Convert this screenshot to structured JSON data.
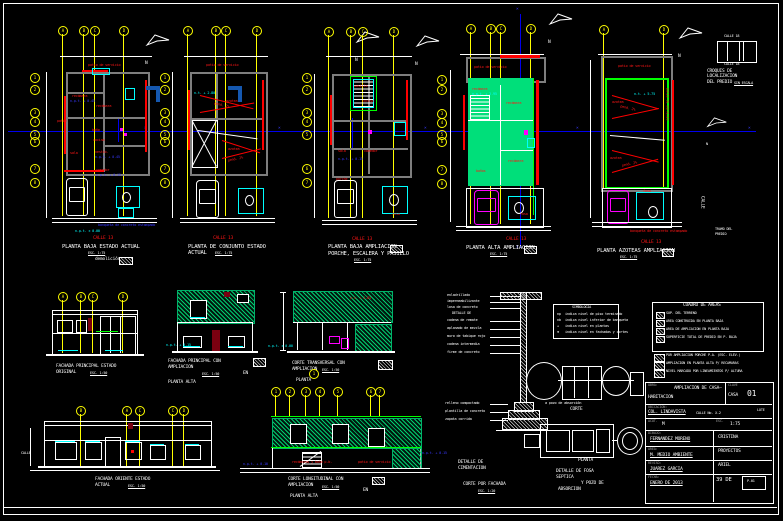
{
  "colors": {
    "background": "#000000",
    "lines": "#ffffff",
    "walls": "#7e7e7e",
    "red": "#ff0000",
    "yellow": "#ffff00",
    "cyan": "#00ffff",
    "blue": "#0000ee",
    "magenta": "#ff00ff",
    "green": "#00ff00",
    "green_fill": "#00df7a",
    "dark_red": "#7a0010",
    "dark_blue": "#1558b0"
  },
  "icons": {
    "x_marker": "×",
    "north": "N"
  },
  "grid": {
    "letters": [
      "A",
      "B",
      "C",
      "D"
    ],
    "numbers": [
      "1",
      "2",
      "3",
      "4",
      "5",
      "6",
      "7",
      "8"
    ]
  },
  "p1": {
    "t": "PLANTA BAJA ESTADO ACTUAL",
    "s": "ESC. 1:75",
    "note": "demolición",
    "street": "CALLE 13",
    "lv0": "n.p.t. ± 0.00",
    "walk": "banqueta de concreto estampado",
    "top": "patio de servicio",
    "r1": "recámara",
    "r2": "recámara",
    "r3": "baño",
    "r4": "patio",
    "r5": "sala",
    "r6": "vestib.",
    "r7": "comedor",
    "r8": "cocina",
    "lv1": "n.p.t. + 0.45",
    "lv2": "n.p.t. + 0.45",
    "lv3": "n.p.t. + 0.15"
  },
  "p2": {
    "t": "PLANTA DE CONJUNTO ESTADO",
    "t2": "ACTUAL",
    "s": "ESC. 1:75",
    "street": "CALLE 13",
    "top": "patio de servicio",
    "r1": "azotea",
    "r2": "azotea",
    "sl1": "pend. 2%",
    "sl2": "pend. 2%",
    "lv1": "n.t. + 2.80"
  },
  "p3": {
    "t": "PLANTA BAJA AMPLIACION",
    "t2": "PORCHE, ESCALERA Y PASILLO",
    "s": "ESC. 1:75",
    "street": "CALLE 13",
    "r1": "sala",
    "r2": "comedor",
    "r3": "cocina",
    "r4": "porche",
    "r5": "pasillo",
    "lv1": "n.p.t. + 0.15",
    "fosa": "fosa"
  },
  "p4": {
    "t": "PLANTA ALTA AMPLIACION",
    "s": "ESC. 1:75",
    "street": "CALLE 13",
    "top": "patio de servicio",
    "r1": "recámara",
    "r2": "recámara",
    "r3": "recámara",
    "r4": "baños",
    "lv1": "n.p.t. + 2.95",
    "fosa": "fosa"
  },
  "p5": {
    "t": "PLANTA AZOTEAS AMPLIACION",
    "s": "ESC. 1:75",
    "street": "CALLE 13",
    "top": "patio de servicio",
    "side": "patio de servicio",
    "r1": "azotea",
    "r2": "azotea",
    "sl1": "pend. 2%",
    "sl2": "pend. 2%",
    "lv1": "n.t. + 5.75",
    "walk": "banqueta de concreto estampado",
    "fosa": "fosa"
  },
  "croquis": {
    "t1": "CROQUIS DE",
    "t2": "LOCALIZACION",
    "t3": "DEL PREDIO",
    "s": "SIN ESCALA",
    "st": "CALLE 18",
    "sb": "CALLE 18",
    "n1": "TRAMO DEL",
    "n2": "PREDIO",
    "side": "CALLE"
  },
  "f1": {
    "t1": "FACHADA PRINCIPAL ESTADO",
    "t2": "ORIGINAL",
    "s": "ESC. 1:50"
  },
  "f2": {
    "t1": "FACHADA PRINCIPAL CON",
    "t2": "AMPLIACION",
    "s": "ESC. 1:50",
    "en": "EN",
    "pa": "PLANTA ALTA",
    "lv": "n.p.t. + 0.15"
  },
  "ct": {
    "t1": "CORTE TRANSVERSAL CON",
    "t2": "AMPLIACION",
    "s": "ESC. 1:50",
    "lv": "n.p.t. ± 0.00",
    "rlv": "n.t. + 2.85",
    "pl": "PLANTA"
  },
  "f3": {
    "t1": "FACHADA ORIENTE ESTADO",
    "t2": "ACTUAL",
    "s": "ESC. 1:50",
    "street": "CALLE"
  },
  "cl": {
    "t1": "CORTE LONGITUDINAL CON",
    "t2": "AMPLIACION",
    "s": "ESC. 1:50",
    "en": "EN",
    "pa": "PLANTA ALTA",
    "red1": "recámaras y baño p.b.",
    "red2": "patio de servicio",
    "lv1": "n.p.t. + 0.10",
    "lv2": "n.p.t. + 0.15"
  },
  "cim": {
    "a1": "enladrillado",
    "a2": "impermeabilizante",
    "a3": "losa de concreto",
    "a4": "cadena de remate",
    "a5": "aplanado de mezcla",
    "a6": "muro de tabique rojo",
    "a7": "cadena intermedia",
    "a8": "firme de concreto",
    "a9": "relleno compactado",
    "a10": "plantilla de concreto",
    "a11": "zapata corrida",
    "mid": "DETALLE DE",
    "l1": "DETALLE DE",
    "l2": "CIMENTACION",
    "t1": "CORTE POR FACHADA",
    "s": "ESC. 1:20"
  },
  "fosa": {
    "note": "a pozo de absorción",
    "corte": "CORTE",
    "planta": "PLANTA",
    "t1": "DETALLE DE FOSA",
    "t2": "SEPTICA",
    "t3": "Y POZO DE",
    "t4": "ABSORCION"
  },
  "simb": {
    "title": "SIMBOLOGIA",
    "k1": "np",
    "v1": "indica nivel de piso terminado",
    "k2": "nb",
    "v2": "indica nivel inferior de banqueta",
    "k3": "+",
    "v3": "indica nivel en plantas",
    "k4": "⊕",
    "v4": "indica nivel en fachadas y cortes"
  },
  "cuadro": {
    "title": "CUADRO DE AREAS",
    "r1": "SUP. DEL TERRENO",
    "r2": "AREA CONSTRUIDA EN PLANTA BAJA",
    "r3": "AREA DE AMPLIACION EN PLANTA BAJA",
    "r4": "SUPERFICIE TOTAL DE PREDIO EN P. BAJA",
    "e1": "POR AMPLIACION PORCHE P.A. (ESC. ELEV.)",
    "e2": "AMPLIACION EN PLANTA ALTA P/ RECAMARAS",
    "e3": "NIVEL MARCADO POR LINEAMIENTOS P/ ALTURA"
  },
  "tb": {
    "obra_label": "OBRA:",
    "obra1": "AMPLIACION DE CASA—",
    "obra2": "HABITACION",
    "clave": "CLAVE",
    "casa": "CASA",
    "num": "01",
    "ub_label": "UBICACION:",
    "ub1": "COL. LINDAVISTA",
    "ub2": "CALLE No. X-2",
    "lote": "LOTE",
    "acotl": "ACOT.",
    "acot": "M",
    "escl": "ESC.",
    "esc": "1:75",
    "d_label": "DIBUJO:",
    "d": "FERNANDEZ MORENO",
    "dr": "CRISTINA",
    "a_label": "AREA:",
    "a": "M. MEDIO AMBIENTE",
    "ar": "PROYECTOS",
    "r_label": "REVISO:",
    "r": "JUAREZ GARCIA",
    "rr": "ARIEL",
    "f_label": "FECHA:",
    "f": "ENERO DE 2013",
    "fr": "39 DE",
    "stamp": "P-01"
  }
}
